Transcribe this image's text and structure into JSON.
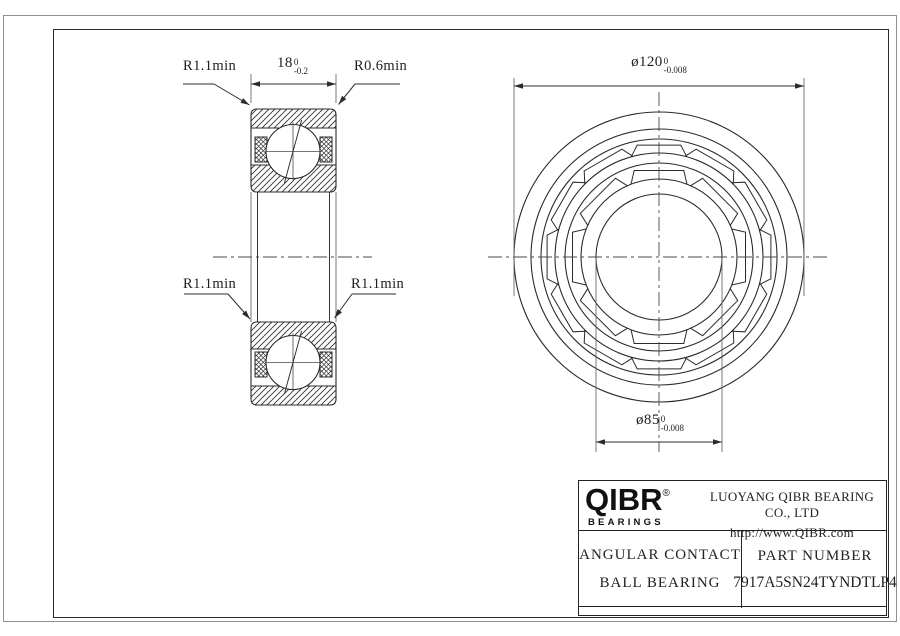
{
  "drawing": {
    "section_view": {
      "dim_width": {
        "value": "18",
        "tol_upper": "0",
        "tol_lower": "-0.2"
      },
      "labels": {
        "fillet_top_left": "R1.1min",
        "fillet_top_right": "R0.6min",
        "fillet_mid_left": "R1.1min",
        "fillet_mid_right": "R1.1min"
      }
    },
    "front_view": {
      "dim_outer_diameter": {
        "value": "ø120",
        "tol_upper": "0",
        "tol_lower": "-0.008"
      },
      "dim_bore_diameter": {
        "value": "ø85",
        "tol_upper": "0",
        "tol_lower": "-0.008"
      }
    }
  },
  "title_block": {
    "logo_text": "QIBR",
    "logo_registered": "®",
    "logo_subtext": "BEARINGS",
    "company_name": "LUOYANG QIBR BEARING CO., LTD",
    "website": "http://www.QIBR.com",
    "product_type_line1": "ANGULAR CONTACT",
    "product_type_line2": "BALL BEARING",
    "part_number_label": "PART NUMBER",
    "part_number": "7917A5SN24TYNDTLP4"
  },
  "colors": {
    "object_line": "#2b2b2b",
    "center_line": "#4a4a4a",
    "extension_line": "#6a6a6a",
    "paper_edge": "#8f8f8f"
  }
}
